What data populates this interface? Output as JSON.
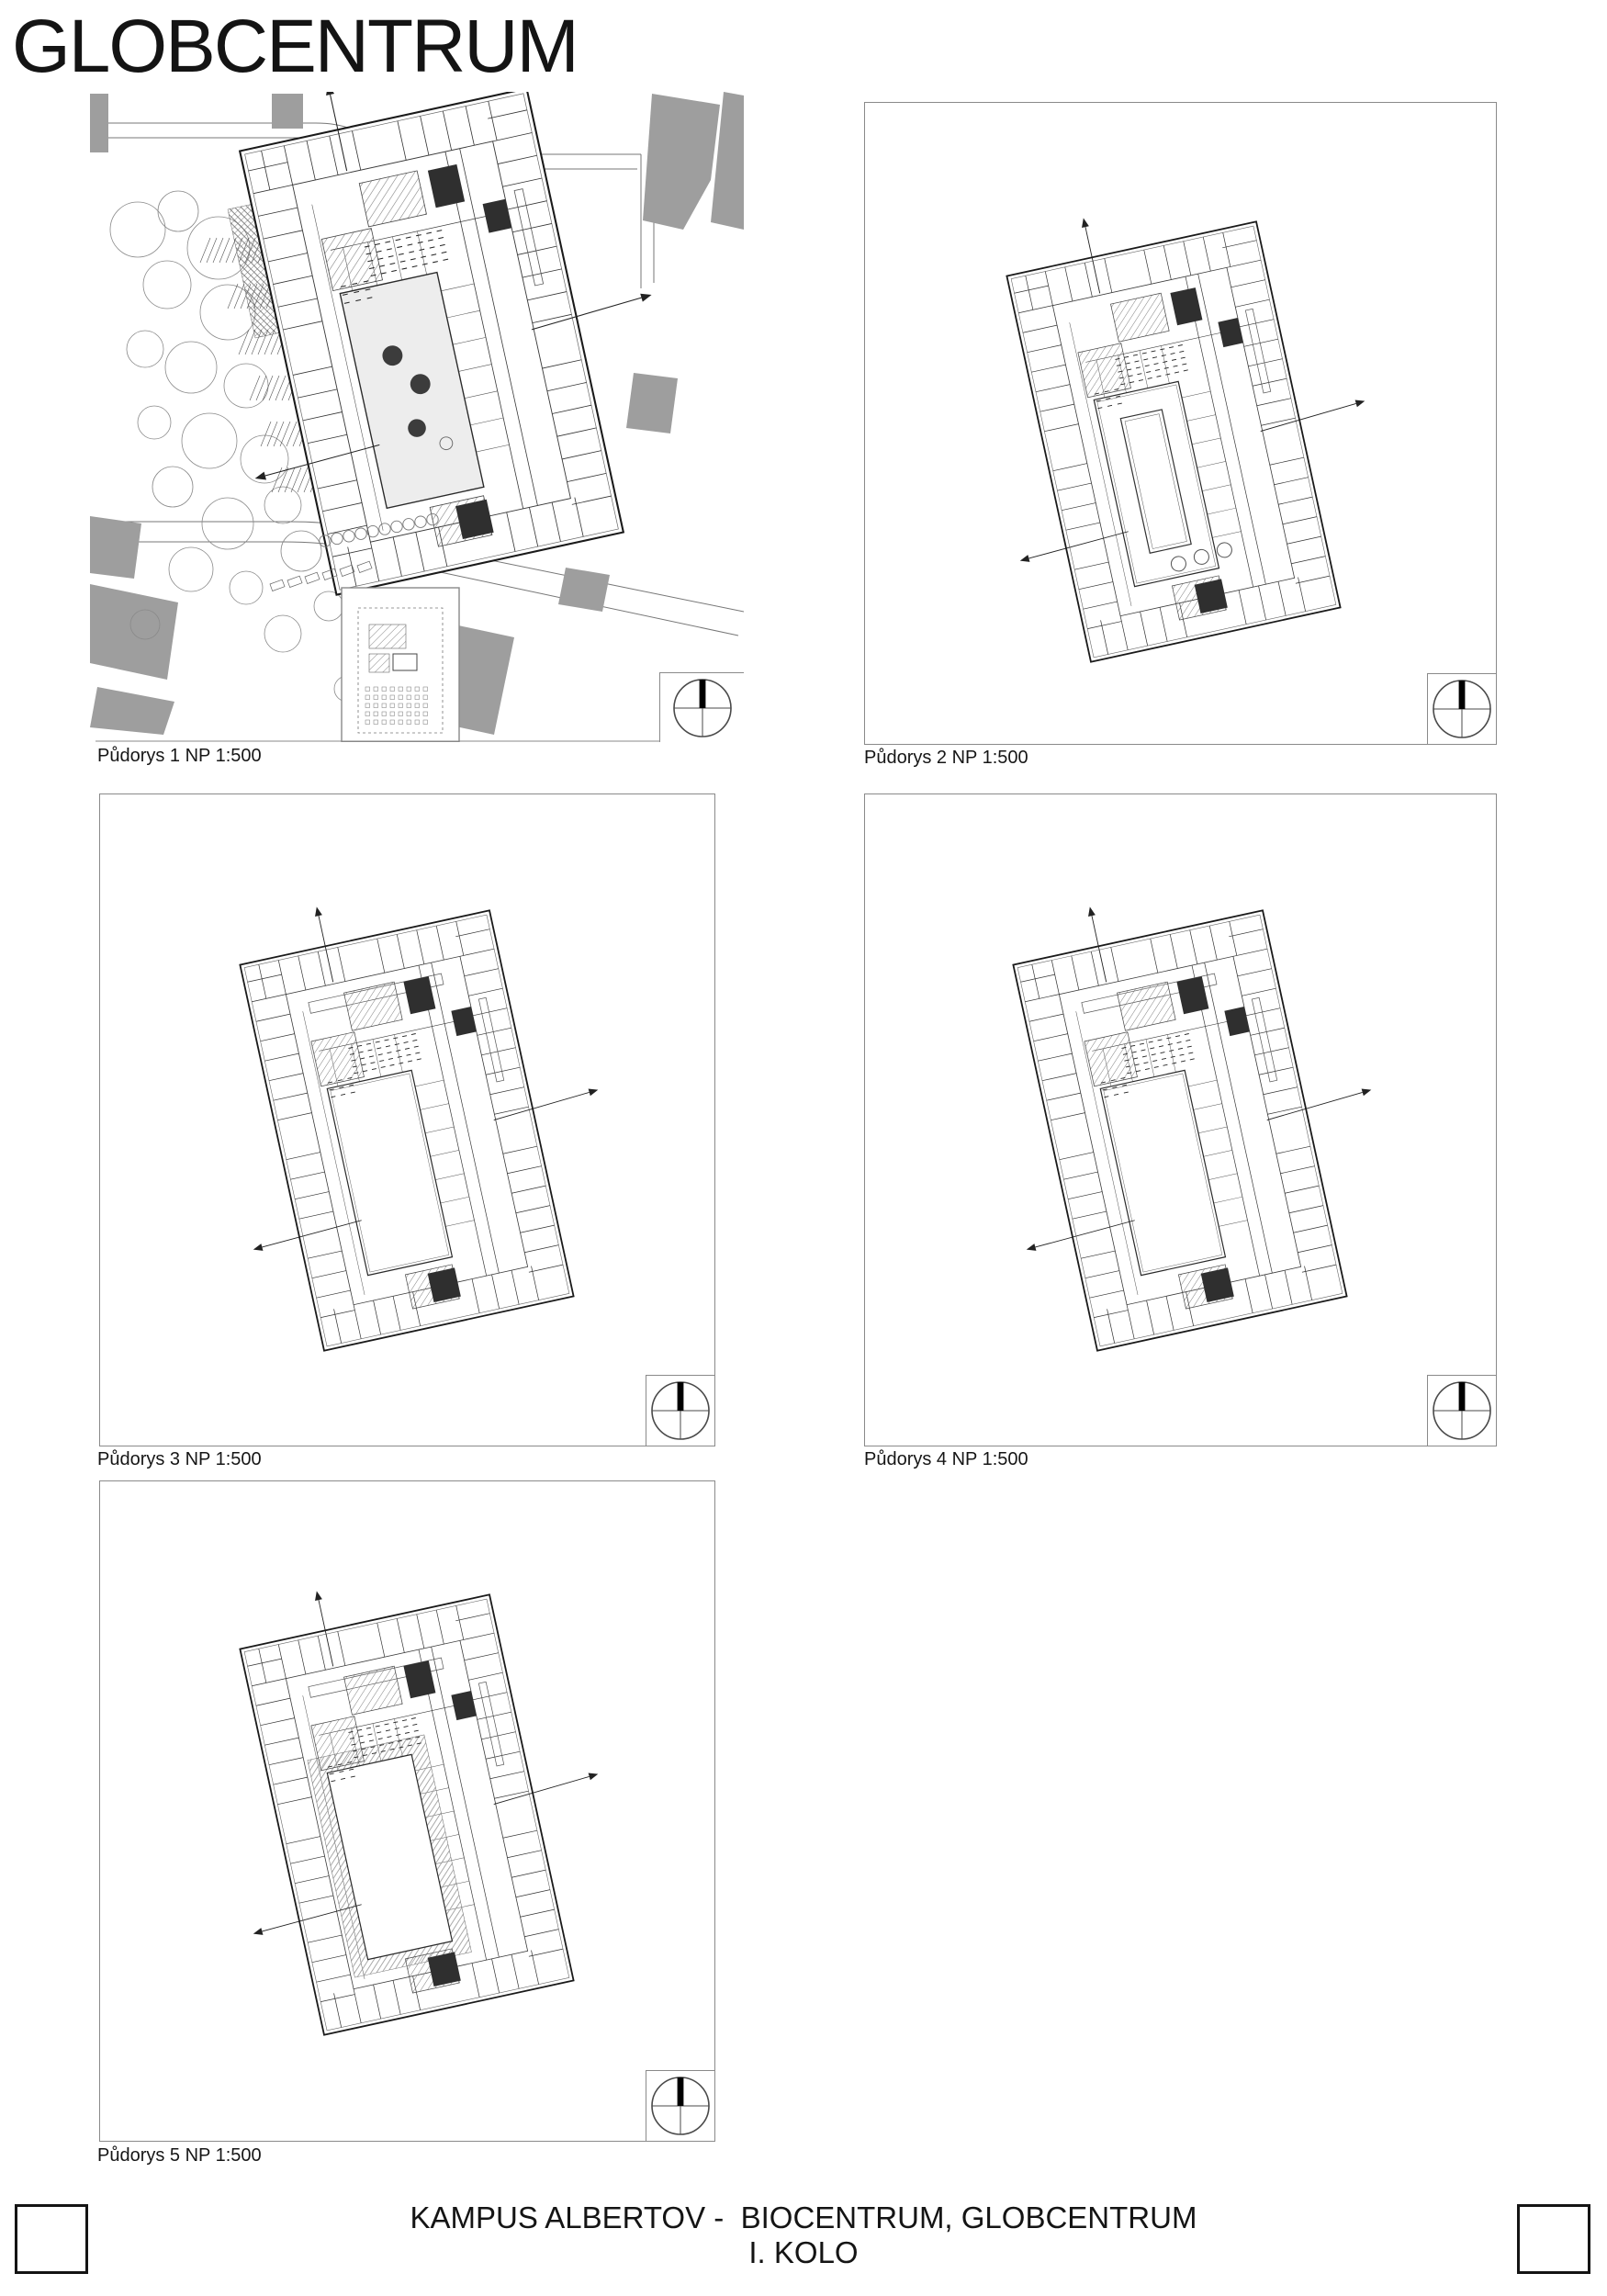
{
  "page": {
    "title": "GLOBCENTRUM"
  },
  "panels": [
    {
      "id": "p1",
      "label": "Půdorys 1 NP 1:500",
      "type": "site",
      "variant": "ground1"
    },
    {
      "id": "p2",
      "label": "Půdorys 2 NP 1:500",
      "type": "floor",
      "variant": "ground2"
    },
    {
      "id": "p3",
      "label": "Půdorys 3 NP 1:500",
      "type": "floor",
      "variant": "typical"
    },
    {
      "id": "p4",
      "label": "Půdorys 4 NP 1:500",
      "type": "floor",
      "variant": "typical"
    },
    {
      "id": "p5",
      "label": "Půdorys 5 NP 1:500",
      "type": "floor",
      "variant": "roof-courtyard"
    }
  ],
  "footer": {
    "line1": "KAMPUS ALBERTOV -  BIOCENTRUM, GLOBCENTRUM",
    "line2": "I. KOLO"
  },
  "icons": {
    "compass": "north-compass-icon"
  },
  "colors": {
    "line": "#2a2a2a",
    "line_light": "#555555",
    "gray_fill": "#9e9e9e",
    "frame": "#8a8a8a",
    "dark_core": "#2f2f2f"
  }
}
